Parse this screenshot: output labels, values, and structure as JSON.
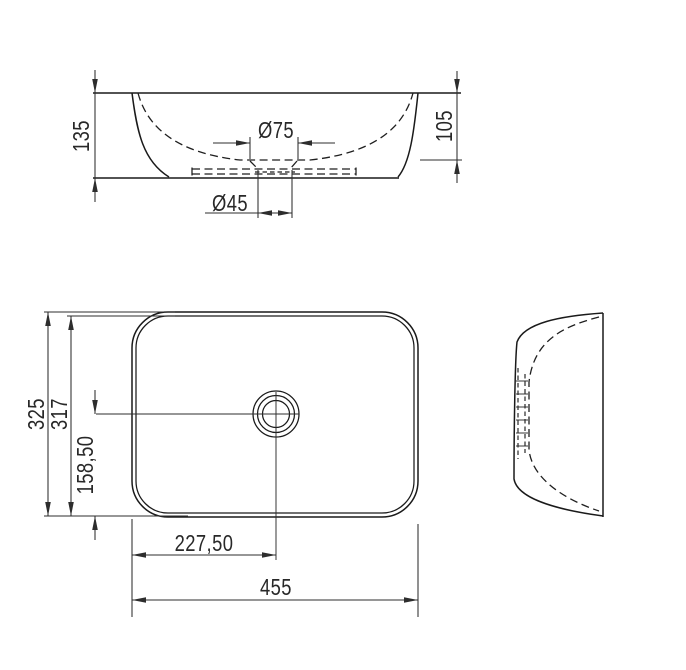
{
  "drawing": {
    "background": "#ffffff",
    "object_line_color": "#1a1a1a",
    "dimension_color": "#2d2d2d",
    "views": {
      "front_elevation": {
        "dims": {
          "overall_height": "135",
          "bowl_depth": "105",
          "drain_recess_diameter": "Ø75",
          "drain_hole_diameter": "Ø45"
        }
      },
      "plan": {
        "dims": {
          "outer_depth": "325",
          "inner_depth": "317",
          "drain_center_from_front": "158,50",
          "drain_center_from_left": "227,50",
          "overall_width": "455"
        }
      },
      "side_elevation": {
        "dims": {}
      }
    }
  }
}
